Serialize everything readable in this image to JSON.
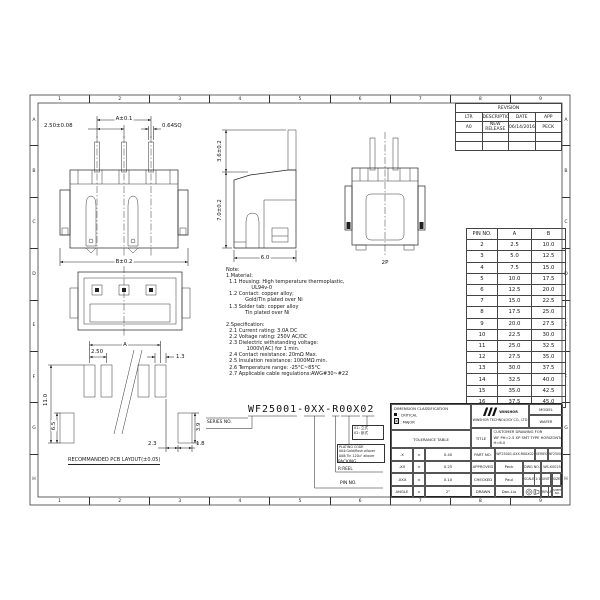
{
  "sheet": {
    "top_numbers": [
      "1",
      "2",
      "3",
      "4",
      "5",
      "6",
      "7",
      "8",
      "9"
    ],
    "bottom_numbers": [
      "1",
      "2",
      "3",
      "4",
      "5",
      "6",
      "7",
      "8",
      "9"
    ],
    "left_letters": [
      "A",
      "B",
      "C",
      "D",
      "E",
      "F",
      "G",
      "H"
    ],
    "right_letters": [
      "A",
      "B",
      "C",
      "D",
      "E",
      "F",
      "G",
      "H"
    ]
  },
  "revision_table": {
    "title": "REVISION",
    "headers": [
      "LTR",
      "DESCRIPTION",
      "DATE",
      "APP"
    ],
    "rows": [
      {
        "ltr": "A0",
        "description": "NEW RELEASE",
        "date": "06/14/2016",
        "app": "PECK"
      }
    ]
  },
  "pin_table": {
    "headers": [
      "PIN NO.",
      "A",
      "B"
    ],
    "rows": [
      {
        "pin": "2",
        "a": "2.5",
        "b": "10.0"
      },
      {
        "pin": "3",
        "a": "5.0",
        "b": "12.5"
      },
      {
        "pin": "4",
        "a": "7.5",
        "b": "15.0"
      },
      {
        "pin": "5",
        "a": "10.0",
        "b": "17.5"
      },
      {
        "pin": "6",
        "a": "12.5",
        "b": "20.0"
      },
      {
        "pin": "7",
        "a": "15.0",
        "b": "22.5"
      },
      {
        "pin": "8",
        "a": "17.5",
        "b": "25.0"
      },
      {
        "pin": "9",
        "a": "20.0",
        "b": "27.5"
      },
      {
        "pin": "10",
        "a": "22.5",
        "b": "30.0"
      },
      {
        "pin": "11",
        "a": "25.0",
        "b": "32.5"
      },
      {
        "pin": "12",
        "a": "27.5",
        "b": "35.0"
      },
      {
        "pin": "13",
        "a": "30.0",
        "b": "37.5"
      },
      {
        "pin": "14",
        "a": "32.5",
        "b": "40.0"
      },
      {
        "pin": "15",
        "a": "35.0",
        "b": "42.5"
      },
      {
        "pin": "16",
        "a": "37.5",
        "b": "45.0"
      }
    ]
  },
  "views": {
    "front": {
      "dim_a": "A±0.1",
      "dim_pitch": "2.50±0.08",
      "dim_sq": "0.64SQ",
      "dim_b": "B±0.2"
    },
    "side": {
      "dim_pin_height": "3.6±0.2",
      "dim_body_height": "7.0±0.2",
      "dim_depth": "6.0"
    },
    "rear": {
      "label": "2P"
    },
    "pcb": {
      "dim_a": "A",
      "dim_pitch": "2.50",
      "dim_pad_w": "1.3",
      "dim_total_h": "11.0",
      "dim_pad_h": "6.5",
      "dim_tab_h": "3.9",
      "dim_gap": "2.3",
      "dim_tab_w": "1.8",
      "caption": "RECOMMANDED PCB LAYOUT(±0.05)"
    }
  },
  "notes": {
    "lines": [
      "Note:",
      "1.Material:",
      "  1.1 Housing: High temperature thermoplastic,",
      "                UL94v-0",
      "  1.2 Contact: copper alloy;",
      "            Gold/Tin plated over Ni",
      "  1.3 Solder tab: copper alloy",
      "            Tin plated over Ni",
      "",
      "2.Specification:",
      "  2.1 Current rating: 3.0A DC",
      "  2.2 Voltage rating: 250V AC/DC",
      "  2.3 Dielectric withstanding voltage:",
      "             1000V(AC) for 1 min.",
      "  2.4 Contact resistance: 20mΩ Max.",
      "  2.5 Insulation resistance: 1000MΩ min.",
      "  2.6 Temperature range: -25°C~85°C",
      "  2.7 Applicable cable regulations:AWG#30~#22"
    ]
  },
  "part_code": {
    "number": "WF25001-0XX-R00X02",
    "series_label": "SERIES NO.",
    "type_codes": [
      "01: 立式",
      "02: 卧式"
    ],
    "plating_lines": [
      "PLATING CODE",
      "004:Gold/flash allover",
      "008:Tin 120u\" allover"
    ],
    "packing_label": "PACKING",
    "packing_value": "R:REEL",
    "pin_label": "PIN NO."
  },
  "title_block": {
    "classification": {
      "title": "DIMENSION CLASSIFICATION",
      "critical": ":  CRITICAL",
      "major": ":  MAJOR"
    },
    "tolerance": {
      "title": "TOLERANCE TABLE",
      "rows": [
        {
          "label": ".X",
          "pm": "±",
          "value": "0.40"
        },
        {
          "label": ".XX",
          "pm": "±",
          "value": "0.25"
        },
        {
          "label": ".XXX",
          "pm": "±",
          "value": "0.10"
        },
        {
          "label": "ANGLE",
          "pm": "±",
          "value": "2°"
        }
      ]
    },
    "company": {
      "logo_text": "WINSHOR",
      "name": "WINSHOR TECHNOLOGY CO., LTD"
    },
    "model": {
      "label": "MODEL",
      "value": "WAFER"
    },
    "title": {
      "label": "TITLE",
      "lines": [
        "CUSTOMER DRAWING FOR",
        "WF PH=2.5 XP SMT TYPE HORIZONTAL",
        "H=6.0"
      ]
    },
    "part_no": {
      "label": "PART NO.",
      "value": "WF25001-0XX-R00X02"
    },
    "series": {
      "label": "SERIES",
      "value": "WF25001"
    },
    "approved": {
      "label": "APPROVED",
      "value": "Peck"
    },
    "dwg_no": {
      "label": "DWG NO.",
      "value": "WS-K0025"
    },
    "checked": {
      "label": "CHECKED",
      "value": "Paul"
    },
    "scale": {
      "label": "SCALE",
      "value": "1:1"
    },
    "unit": {
      "label": "UNIT",
      "value": "mm"
    },
    "size": {
      "label": "SIZE",
      "value": "A4"
    },
    "drawn": {
      "label": "DRAWN",
      "value": "Dan-Liu"
    },
    "rev": {
      "label": "REV",
      "value": "A0"
    },
    "sheet_no": {
      "label": "SHEET NO.",
      "value": "1/1"
    }
  }
}
